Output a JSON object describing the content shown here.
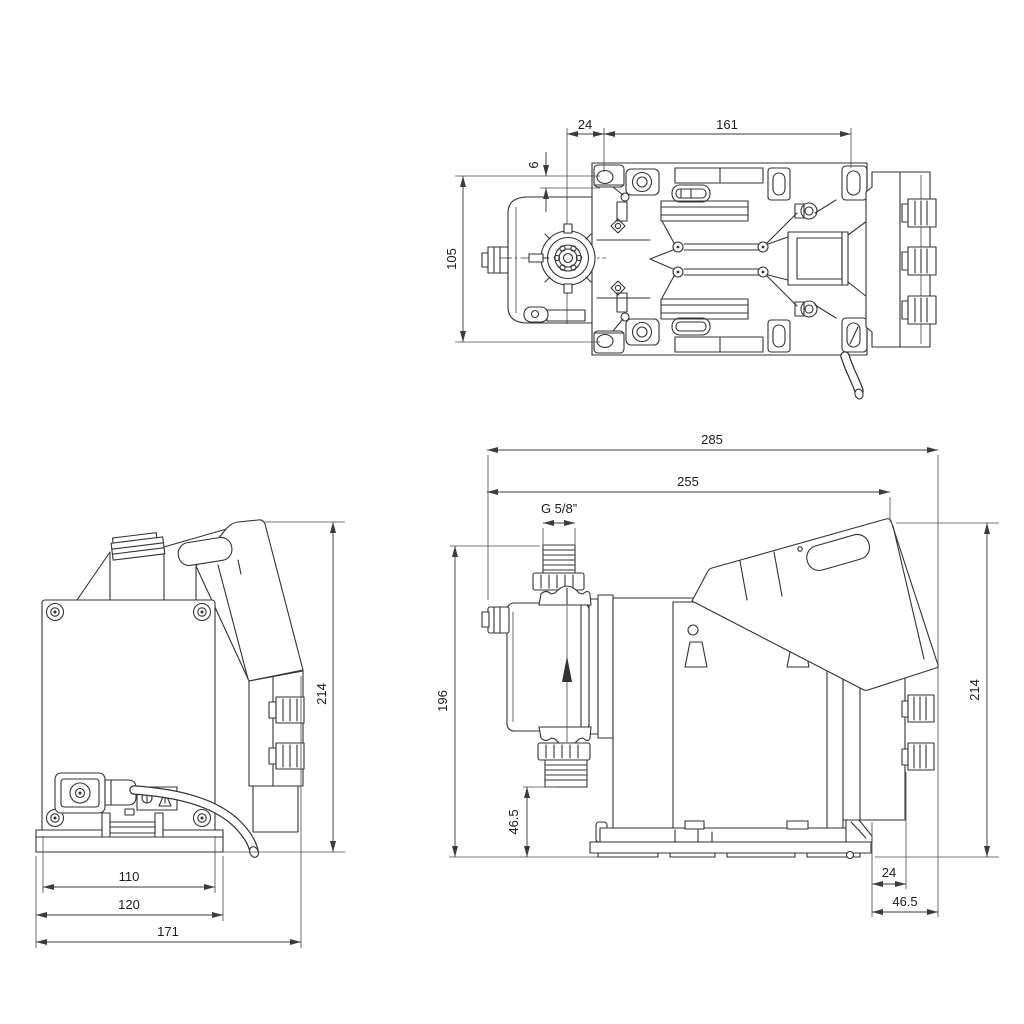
{
  "drawing": {
    "type": "dimensional technical drawing, dosing pump, three orthographic views",
    "background": "#ffffff",
    "line_color": "#333333",
    "dim_color": "#3b3b3b",
    "views": {
      "top": {
        "label": "top view",
        "dims": {
          "d24": "24",
          "d161": "161",
          "d6": "6",
          "d105": "105"
        }
      },
      "back": {
        "label": "rear view",
        "dims": {
          "d214": "214",
          "d110": "110",
          "d120": "120",
          "d171": "171"
        }
      },
      "side": {
        "label": "side view",
        "dims": {
          "d285": "285",
          "d255": "255",
          "thread": "G 5/8”",
          "d196": "196",
          "d46_5_bottom": "46.5",
          "d214": "214",
          "d24": "24",
          "d46_5_rear": "46.5"
        }
      }
    }
  }
}
